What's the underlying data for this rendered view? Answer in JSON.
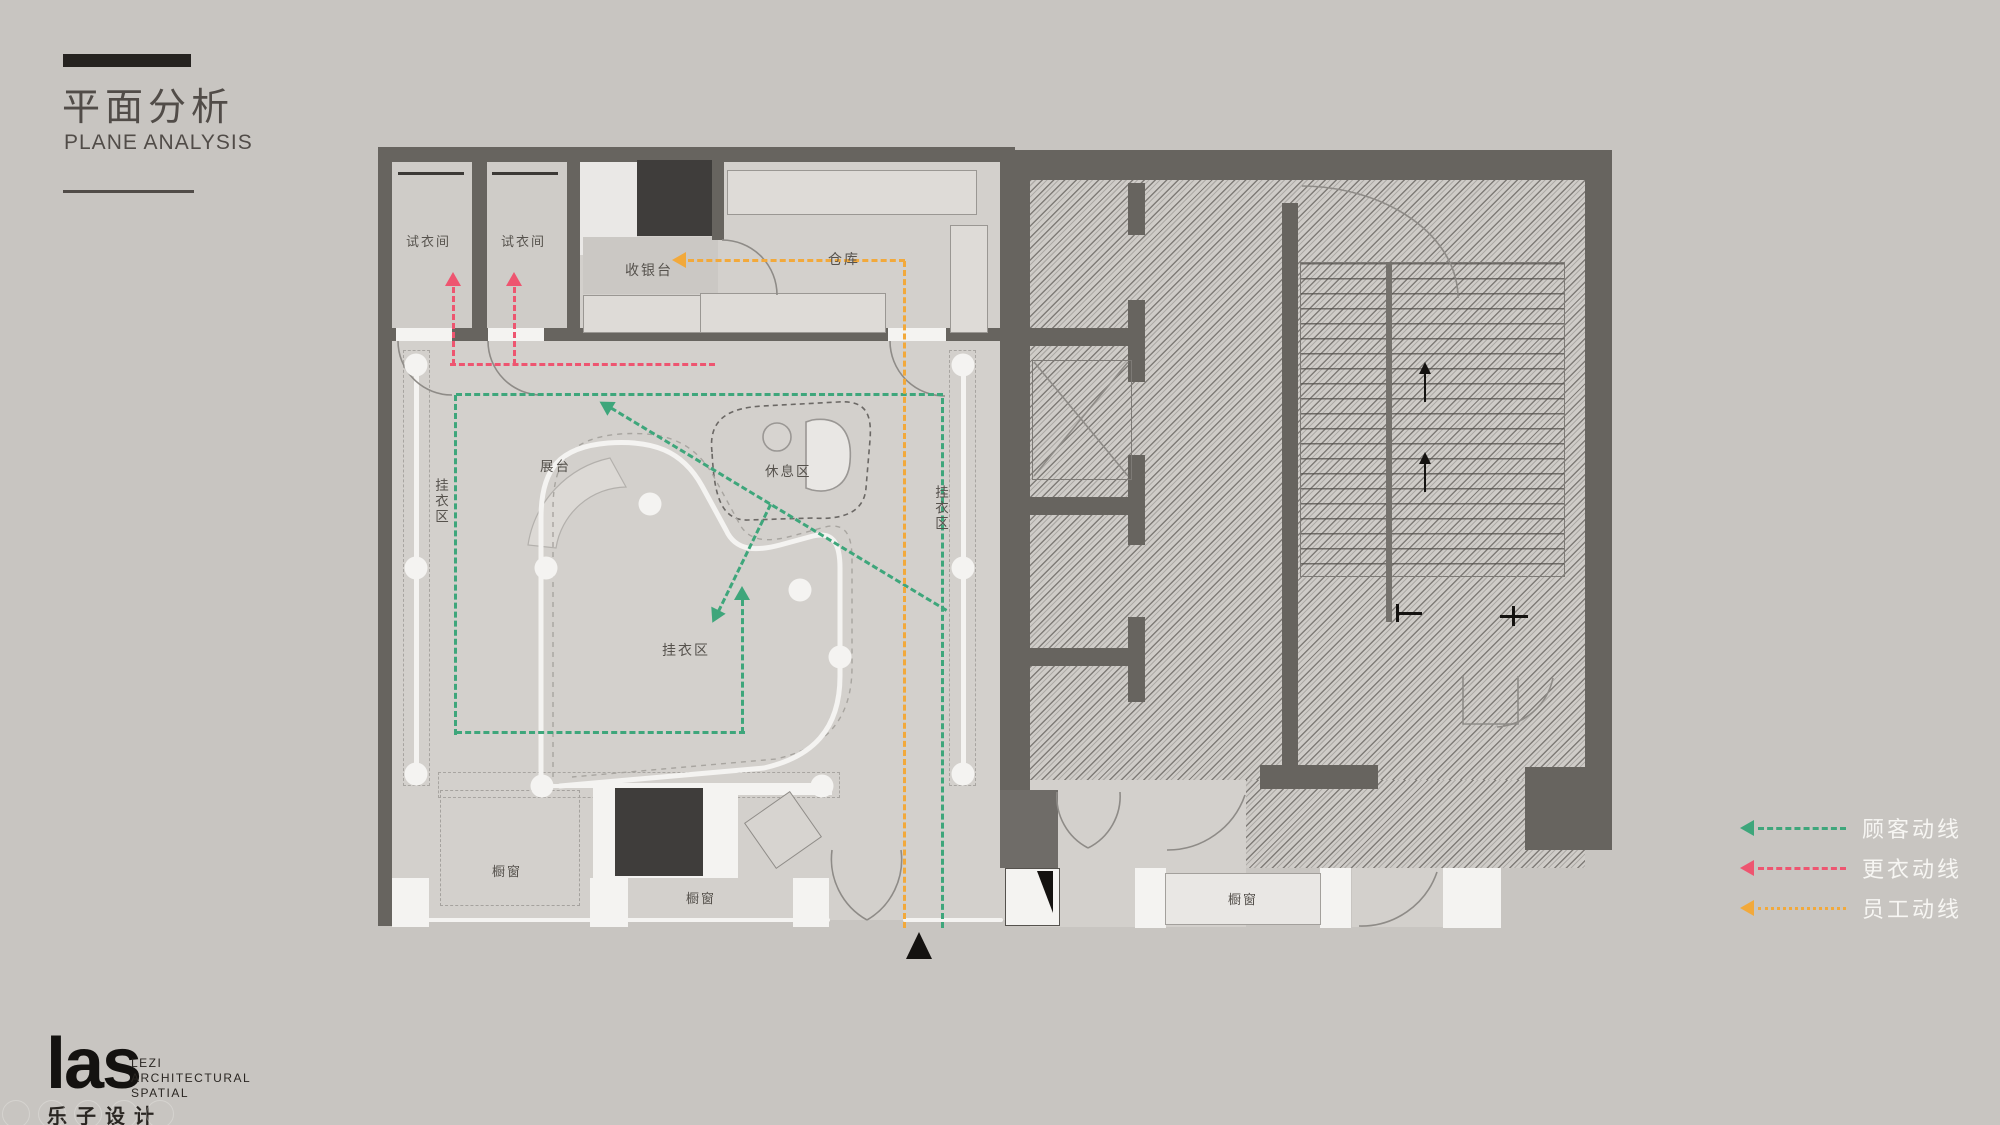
{
  "title": {
    "zh": "平面分析",
    "en": "PLANE ANALYSIS"
  },
  "legend": {
    "items": [
      {
        "label": "顾客动线",
        "meaning": "customer circulation",
        "color": "#3ea67b",
        "style": "dashed"
      },
      {
        "label": "更衣动线",
        "meaning": "changing circulation",
        "color": "#ee5570",
        "style": "dashed"
      },
      {
        "label": "员工动线",
        "meaning": "staff circulation",
        "color": "#f2a93b",
        "style": "dotted"
      }
    ]
  },
  "plan": {
    "fitting_room_1": "试衣间",
    "fitting_room_2": "试衣间",
    "cashier": "收银台",
    "storage": "仓库",
    "hanging_left": "挂衣区",
    "hanging_right": "挂衣区",
    "hanging_center": "挂衣区",
    "display_stand": "展台",
    "rest_area": "休息区",
    "window_left": "橱窗",
    "window_center": "橱窗",
    "window_right": "橱窗"
  },
  "logo": {
    "mark": "las",
    "sub1": "LEZI",
    "sub2": "ARCHITECTURAL",
    "sub3": "SPATIAL",
    "zh": "乐子设计"
  },
  "colors": {
    "customer": "#3ea67b",
    "changing": "#ee5570",
    "staff": "#f2a93b",
    "wall": "#67645f",
    "floor": "#d3d0cc"
  }
}
